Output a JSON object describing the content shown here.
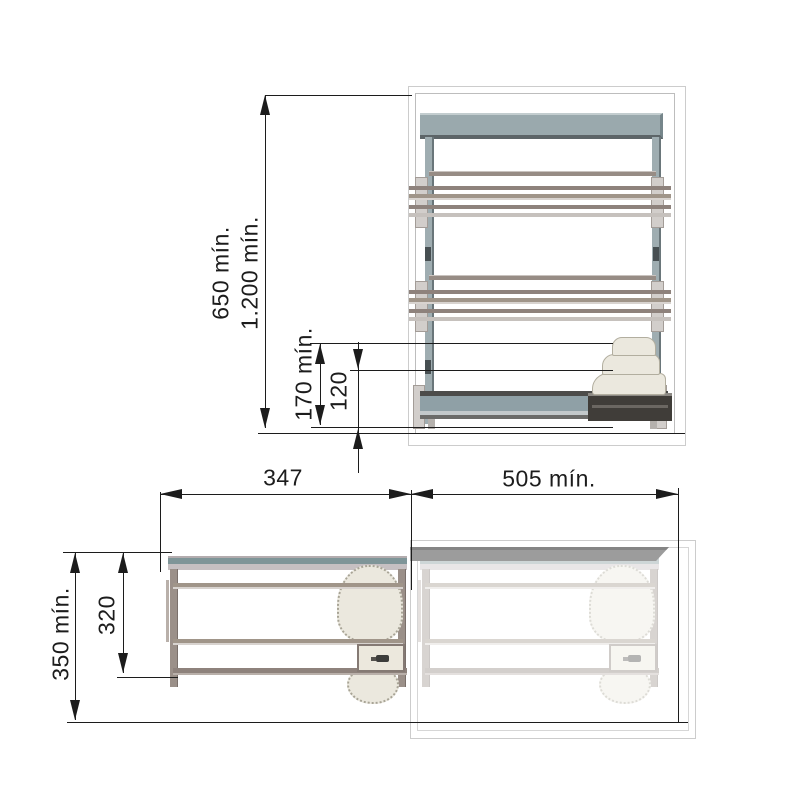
{
  "title": "Pull-out shoe rack installation dimensions (elevation and plan views)",
  "dimensions": {
    "elevation": {
      "height_min": "650 mín.",
      "column_height_min": "1.200 mín.",
      "shoe_clearance_min": "170 mín.",
      "rack_height": "120"
    },
    "plan": {
      "unit_width": "347",
      "cabinet_width_min": "505 mín.",
      "cabinet_depth_min": "350 mín.",
      "unit_depth": "320"
    }
  },
  "colors": {
    "line": "#1c1c1c",
    "outline": "#cccccc",
    "outline2": "#bdbdbd",
    "panel": "#9aa9ad",
    "panel-light": "#c3cdcf",
    "panel-dark": "#5d6568",
    "post": "#9fadb1",
    "rail-dark": "#8e827c",
    "rail-mid": "#a09589",
    "rail-light": "#d8d3cf",
    "bracket": "#d2cecb",
    "bracket-edge": "#a39c97",
    "base-dark": "#4c4c4a",
    "base-body": "#8fa0a6",
    "base-light": "#c3c9cb",
    "rack-dark": "#403d39",
    "ivory": "#ebe8de",
    "ivory-edge": "#b2ae9f",
    "strip-top": "#b3acae",
    "strip-teal": "#7f9598",
    "strip-light": "#c6c0c2",
    "plan-post": "#9b9089",
    "cab-strip": "#9c9c9c",
    "cab-strip-dark": "#858585"
  }
}
